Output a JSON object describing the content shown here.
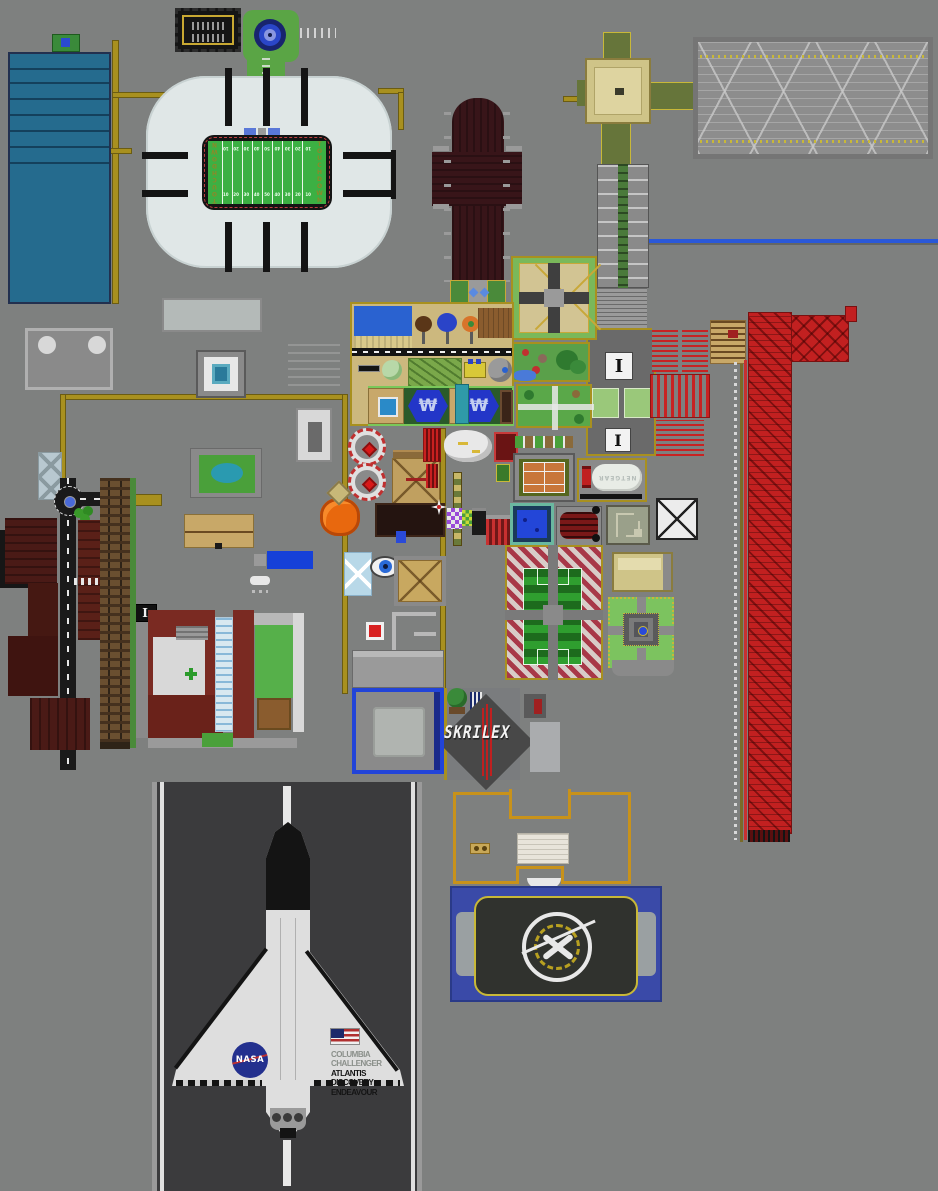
{
  "stadium": {
    "endzone": "TOUCHDOWN",
    "yards": [
      "10",
      "20",
      "30",
      "40",
      "50",
      "40",
      "30",
      "20",
      "10"
    ]
  },
  "markers": {
    "info": "I"
  },
  "landmarks": {
    "skrillex_text": "SKRILEX",
    "router_text": "NETGEAR",
    "hex_glyph": "₩"
  },
  "shuttle": {
    "agency": "NASA",
    "fleet": [
      "COLUMBIA",
      "CHALLENGER",
      "ATLANTIS",
      "DISCOVERY",
      "ENDEAVOUR"
    ]
  },
  "colors": {
    "background": "#7e807f",
    "path_yellow": "#a8901f",
    "field_green": "#3cb043",
    "stadium_shell": "#e0e7e7",
    "cathedral_maroon": "#381519",
    "coaster_red": "#c22020",
    "water_blue": "#2a62d0",
    "droneship_water": "#3a4aa8",
    "runway_asphalt": "#3b3b3d",
    "hospital_maroon": "#7a2a22",
    "teal_building": "#256b8e"
  }
}
